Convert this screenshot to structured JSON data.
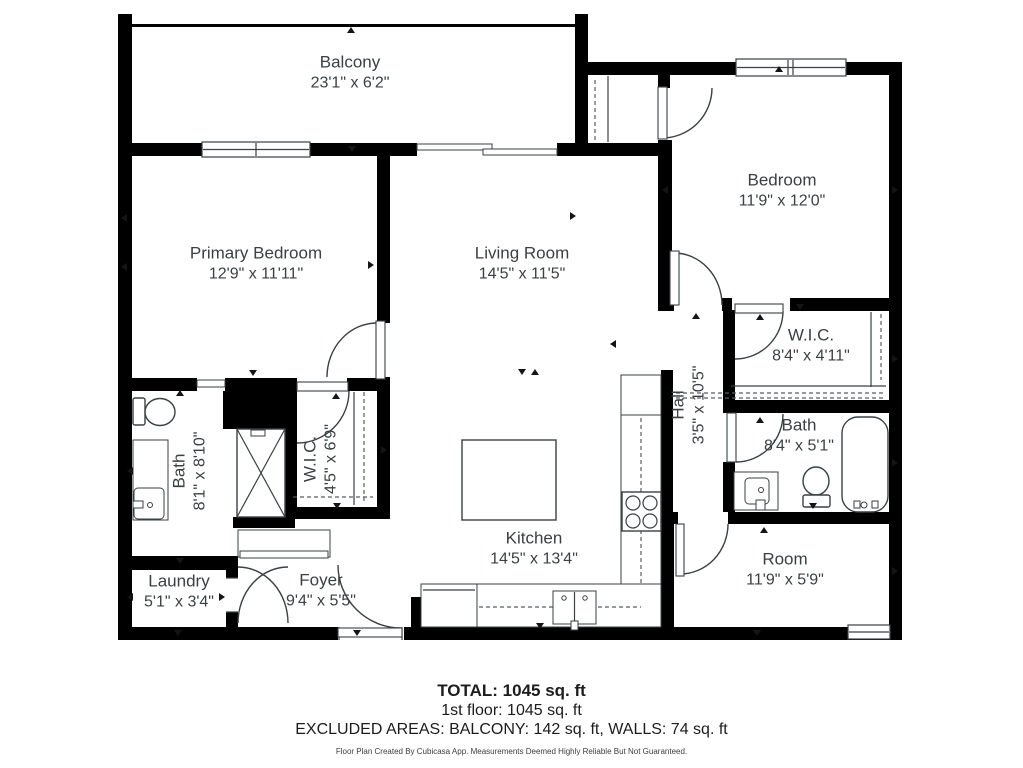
{
  "rooms": [
    {
      "id": "balcony",
      "name": "Balcony",
      "dims": "23'1\" x 6'2\""
    },
    {
      "id": "bedroom",
      "name": "Bedroom",
      "dims": "11'9\" x 12'0\""
    },
    {
      "id": "primary-bedroom",
      "name": "Primary Bedroom",
      "dims": "12'9\" x 11'11\""
    },
    {
      "id": "living-room",
      "name": "Living Room",
      "dims": "14'5\" x 11'5\""
    },
    {
      "id": "wic-right",
      "name": "W.I.C.",
      "dims": "8'4\" x 4'11\""
    },
    {
      "id": "hall",
      "name": "Hall",
      "dims": "3'5\" x 10'5\""
    },
    {
      "id": "bath-right",
      "name": "Bath",
      "dims": "8'4\" x 5'1\""
    },
    {
      "id": "bath-left",
      "name": "Bath",
      "dims": "8'1\" x 8'10\""
    },
    {
      "id": "wic-left",
      "name": "W.I.C.",
      "dims": "4'5\" x 6'9\""
    },
    {
      "id": "kitchen",
      "name": "Kitchen",
      "dims": "14'5\" x 13'4\""
    },
    {
      "id": "room",
      "name": "Room",
      "dims": "11'9\" x 5'9\""
    },
    {
      "id": "laundry",
      "name": "Laundry",
      "dims": "5'1\" x 3'4\""
    },
    {
      "id": "foyer",
      "name": "Foyer",
      "dims": "9'4\" x 5'5\""
    }
  ],
  "summary": {
    "total": "TOTAL: 1045 sq. ft",
    "first_floor": "1st floor: 1045 sq. ft",
    "excluded": "EXCLUDED AREAS: BALCONY: 142 sq. ft, WALLS: 74 sq. ft",
    "disclaimer": "Floor Plan Created By Cubicasa App. Measurements Deemed Highly Reliable But Not Guaranteed."
  },
  "colors": {
    "wall": "#000000",
    "line": "#3a4043",
    "text": "#3a4043"
  }
}
